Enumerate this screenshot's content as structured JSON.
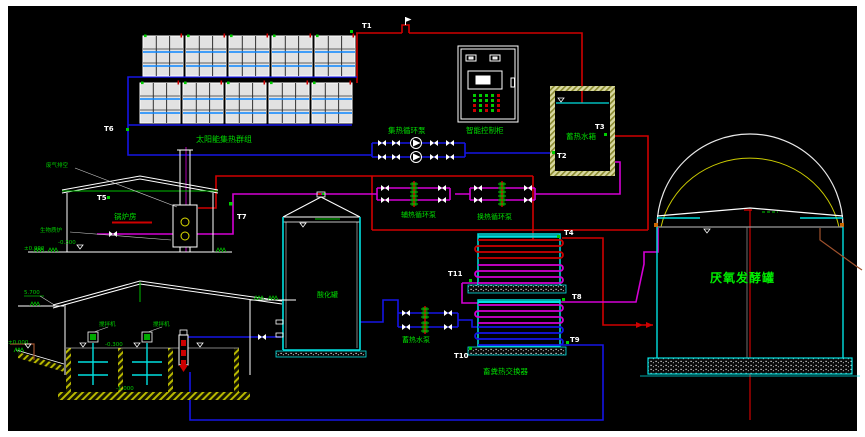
{
  "title": "solar-heated biogas plant piping schematic",
  "labels": {
    "solar_array": "太阳能集热群组",
    "collection_pump": "集热循环泵",
    "control_cabinet": "智能控制柜",
    "storage_tank": "蓄热水箱",
    "aux_heat_pump": "辅热循环泵",
    "heat_exchange_pump": "换热循环泵",
    "storage_water_pump": "蓄热水泵",
    "acidification_tank": "酸化罐",
    "manure_heat_exchanger": "畜粪热交换器",
    "anaerobic_digester": "厌氧发酵罐",
    "boiler_room": "锅炉房",
    "exhaust_vent": "废气排空",
    "biomass_boiler": "生物质炉",
    "mixer": "搅拌机"
  },
  "tags": {
    "t1": "T1",
    "t2": "T2",
    "t3": "T3",
    "t4": "T4",
    "t5": "T5",
    "t6": "T6",
    "t7": "T7",
    "t8": "T8",
    "t9": "T9",
    "t10": "T10",
    "t11": "T11"
  },
  "elevations": {
    "roof_eave": "5.700",
    "ground": "±0.000",
    "boiler_ground": "±0.000",
    "boiler_pit": "-0.300",
    "pool_top": "-0.300",
    "pool_bottom": "-1.000"
  },
  "colors": {
    "background": "#000000",
    "hot_supply_red": "#cf0000",
    "return_blue": "#1515e6",
    "heating_loop_magenta": "#d400d4",
    "equipment_cyan": "#00e0e0",
    "label_green": "#00dd00",
    "structure_white": "#ffffff",
    "hatch_yellow": "#b8b800"
  }
}
